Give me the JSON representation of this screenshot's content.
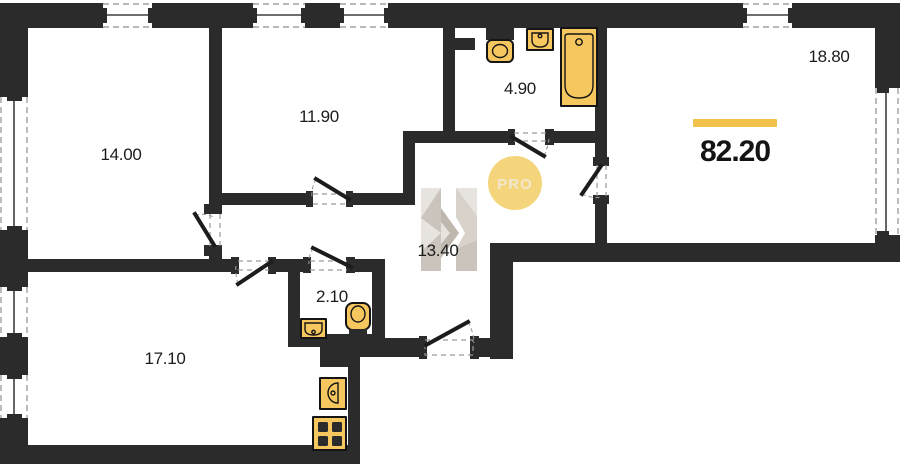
{
  "floorplan": {
    "total_area": "82.20",
    "rooms": {
      "bedroom_left": "14.00",
      "bedroom_middle": "11.90",
      "bathroom": "4.90",
      "living_room": "18.80",
      "hallway": "13.40",
      "wc": "2.10",
      "kitchen_living": "17.10"
    },
    "watermark": {
      "badge_text": "PRO",
      "logo_letter": "H"
    },
    "fixtures": [
      "bathtub",
      "toilet",
      "sink",
      "wc-sink",
      "wc-toilet",
      "kitchen-sink",
      "stove"
    ],
    "colors": {
      "wall": "#2b2b2b",
      "fixture_fill": "#f6c75e",
      "accent_bar": "#f0c24b",
      "badge_fill": "#f5d57c",
      "badge_text": "#f1e7cc",
      "logo_gray": "#d8d2cb"
    }
  }
}
